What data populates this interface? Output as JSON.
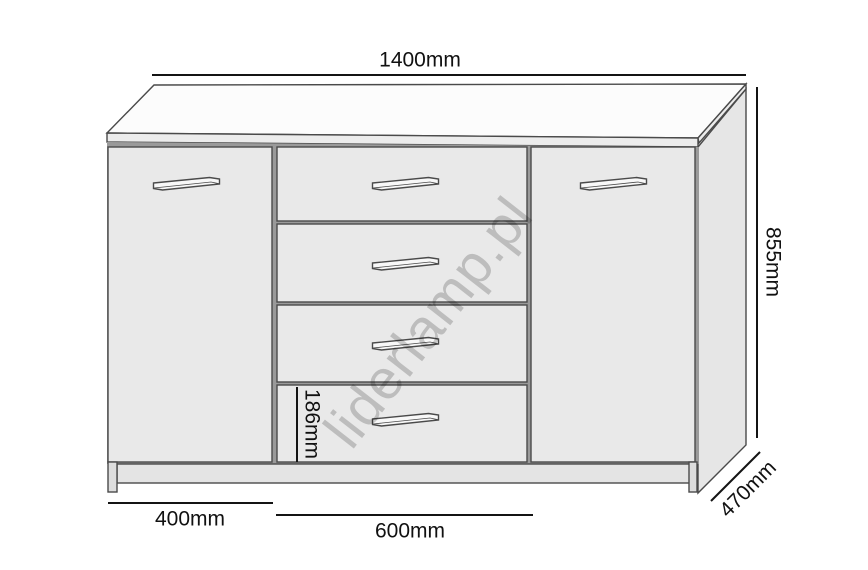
{
  "diagram": {
    "subject": "sideboard",
    "doors": 2,
    "drawers": 4
  },
  "dimensions": {
    "total_width": "1400mm",
    "total_height": "855mm",
    "depth": "470mm",
    "left_door_width": "400mm",
    "drawer_section_width": "600mm",
    "drawer_front_height": "186mm"
  },
  "watermark": "liderlamp.pl",
  "colors": {
    "top_surface": "#fcfcfc",
    "edge_band": "#ececec",
    "side_panel": "#e6e6e6",
    "carcass_gap": "#9a9a9a",
    "front_panel": "#e9e9e9",
    "plinth": "#e4e4e4",
    "foot": "#dddddd",
    "handle_face": "#f8f8f8",
    "outline": "#4a4a4a",
    "dimension_text": "#111111",
    "watermark": "#cfcfcf"
  }
}
